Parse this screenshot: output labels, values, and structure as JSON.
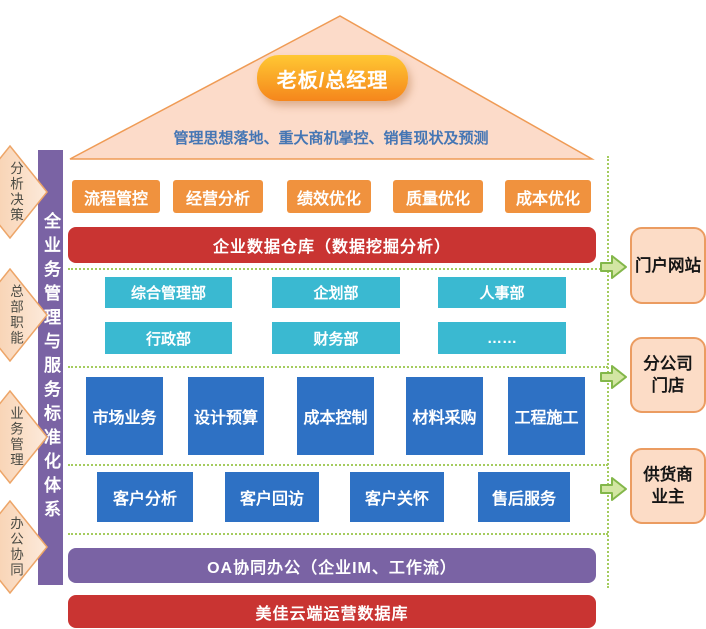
{
  "roof": {
    "title": "老板/总经理",
    "subtitle": "管理思想落地、重大商机掌控、销售现状及预测"
  },
  "left_rail": {
    "label": "全业务管理与服务标准化体系"
  },
  "left_arrows": [
    {
      "label": "分析决策"
    },
    {
      "label": "总部职能"
    },
    {
      "label": "业务管理"
    },
    {
      "label": "办公协同"
    }
  ],
  "kpi_row": [
    {
      "label": "流程管控"
    },
    {
      "label": "经营分析"
    },
    {
      "label": "绩效优化"
    },
    {
      "label": "质量优化"
    },
    {
      "label": "成本优化"
    }
  ],
  "warehouse_bar": {
    "label": "企业数据仓库（数据挖掘分析）"
  },
  "dept_row_1": [
    {
      "label": "综合管理部"
    },
    {
      "label": "企划部"
    },
    {
      "label": "人事部"
    }
  ],
  "dept_row_2": [
    {
      "label": "行政部"
    },
    {
      "label": "财务部"
    },
    {
      "label": "……"
    }
  ],
  "business_row": [
    {
      "label": "市场业务"
    },
    {
      "label": "设计预算"
    },
    {
      "label": "成本控制"
    },
    {
      "label": "材料采购"
    },
    {
      "label": "工程施工"
    }
  ],
  "customer_row": [
    {
      "label": "客户分析"
    },
    {
      "label": "客户回访"
    },
    {
      "label": "客户关怀"
    },
    {
      "label": "售后服务"
    }
  ],
  "oa_bar": {
    "label": "OA协同办公（企业IM、工作流）"
  },
  "cloud_db_bar": {
    "label": "美佳云端运营数据库"
  },
  "right_panels": [
    {
      "lines": [
        "门户网站"
      ]
    },
    {
      "lines": [
        "分公司",
        "门店"
      ]
    },
    {
      "lines": [
        "供货商",
        "业主"
      ]
    }
  ],
  "colors": {
    "roof_fill": "#fcdbc9",
    "roof_border": "#ef9b55",
    "boss_gradient_top": "#ffc833",
    "boss_gradient_bottom": "#f5861c",
    "subtitle_text": "#4576b4",
    "kpi_orange": "#f0923e",
    "bar_red": "#c93432",
    "dept_teal": "#3ab9d1",
    "business_blue": "#2e71c4",
    "bar_purple": "#7a63a4",
    "rail_purple": "#7a63a4",
    "diamond_peach": "#f9d3b0",
    "diamond_border": "#eda568",
    "panel_peach": "#fcdcc6",
    "panel_border": "#eb9c61",
    "connector_green": "#a5cc5e",
    "flow_arrow_fill": "#d3e6a3",
    "flow_arrow_border": "#83b74a",
    "box_text": "#ffffff",
    "diamond_text": "#4b4b44"
  }
}
